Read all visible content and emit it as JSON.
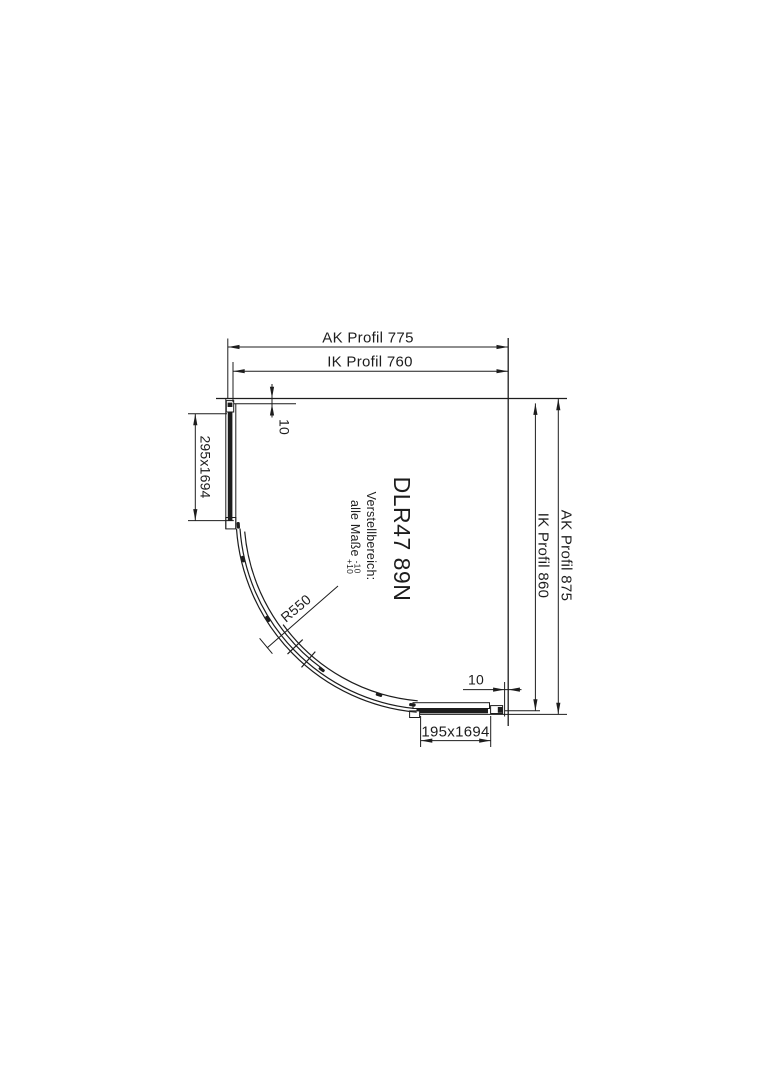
{
  "drawing": {
    "product_code": "DLR47 89N",
    "adjustment": {
      "title": "Verstellbereich:",
      "scope": "alle Maße",
      "tolerance_minus": "-10",
      "tolerance_plus": "+10"
    },
    "dimensions": {
      "top_outer": "AK Profil 775",
      "top_inner": "IK Profil 760",
      "right_outer": "AK Profil 875",
      "right_inner": "IK Profil 860",
      "left_panel": "295x1694",
      "bottom_panel": "195x1694",
      "radius": "R550",
      "gap_top": "10",
      "gap_bottom": "10"
    },
    "colors": {
      "line": "#1d1d1d",
      "background": "#ffffff"
    }
  }
}
